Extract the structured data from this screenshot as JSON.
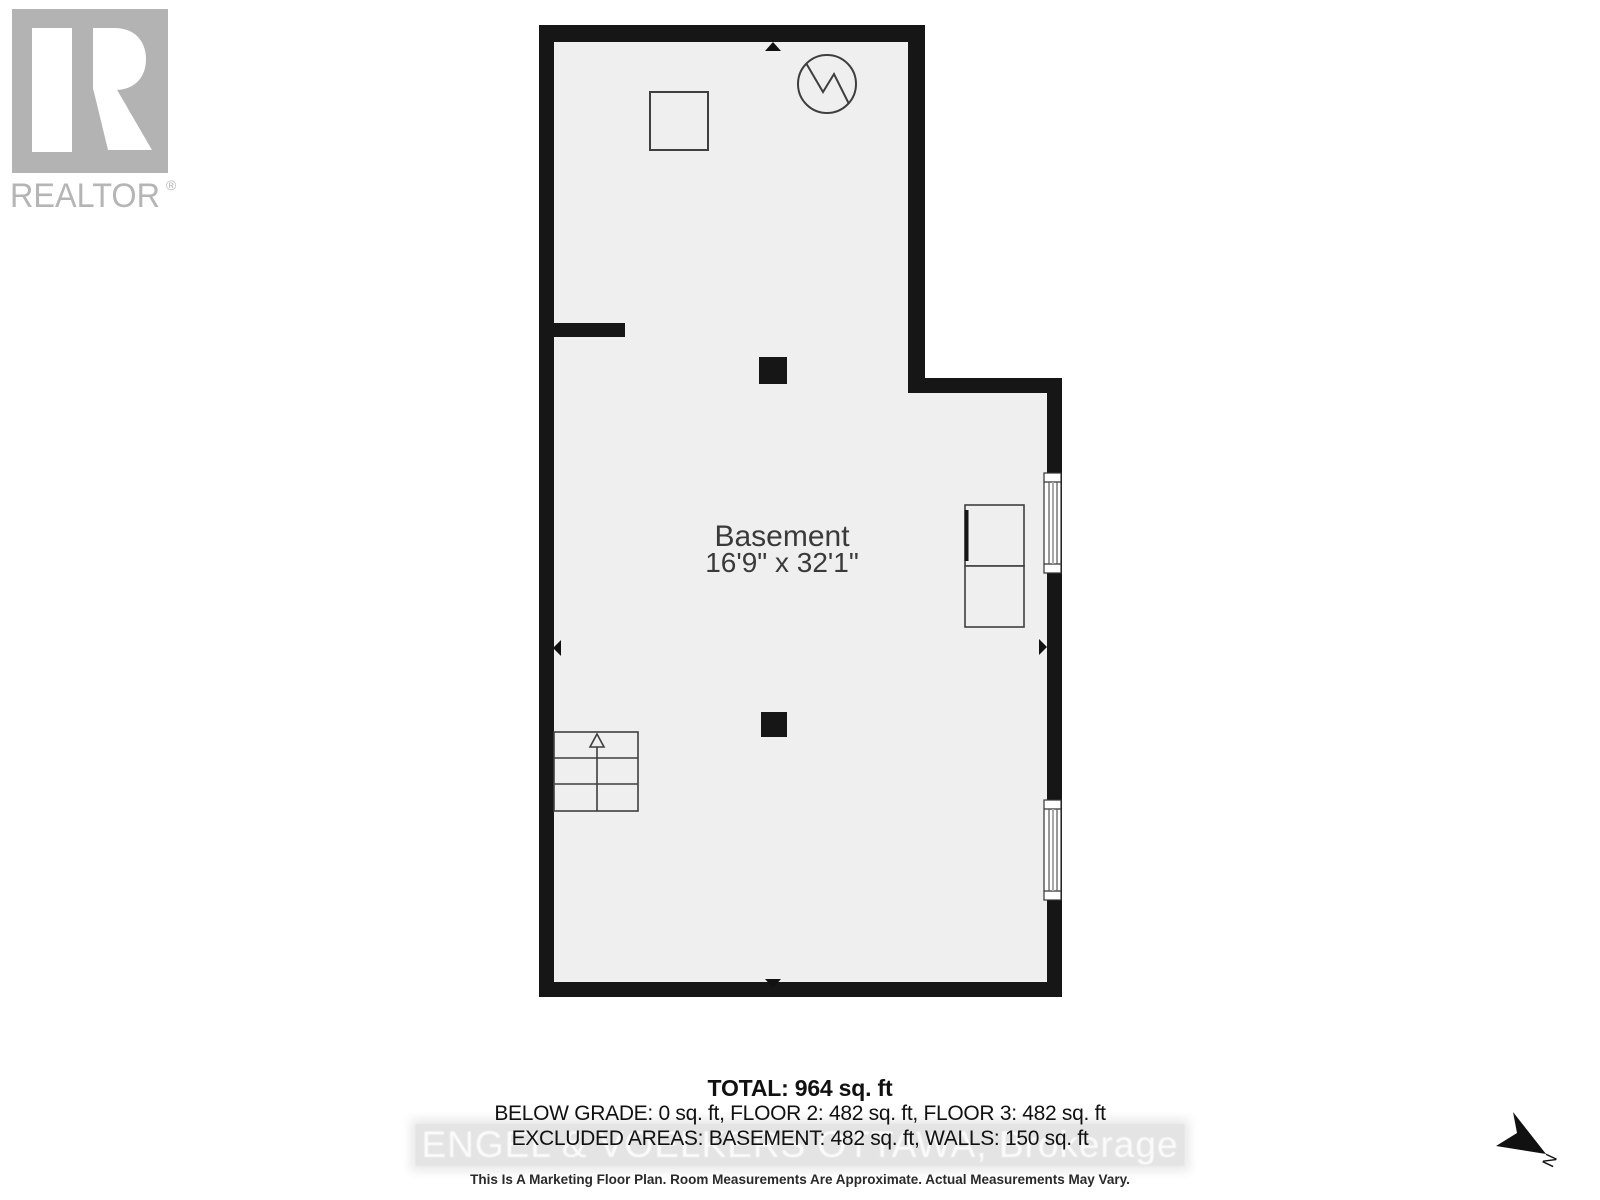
{
  "branding": {
    "logo_text": "REALTOR",
    "registered_mark": "®"
  },
  "plan": {
    "room_name": "Basement",
    "room_dimensions": "16'9\" x 32'1\""
  },
  "summary": {
    "total_line": "TOTAL: 964 sq. ft",
    "grade_line": "BELOW GRADE: 0 sq. ft, FLOOR 2: 482 sq. ft, FLOOR 3: 482 sq. ft",
    "excluded_line": "EXCLUDED AREAS: BASEMENT: 482 sq. ft, WALLS: 150 sq. ft"
  },
  "watermark_text": "ENGEL & VOELKERS OTTAWA, Brokerage",
  "disclaimer_text": "This Is A Marketing Floor Plan. Room Measurements Are Approximate. Actual Measurements May Vary.",
  "compass": {
    "north_label": "N"
  },
  "colors": {
    "wall": "#161616",
    "floor_fill": "#efefef",
    "symbol_stroke": "#3f3f3f",
    "logo_gray": "#b3b3b3",
    "watermark_band": "#e4e4e4",
    "watermark_text": "#fbfbfb",
    "text_dark": "#111111"
  }
}
